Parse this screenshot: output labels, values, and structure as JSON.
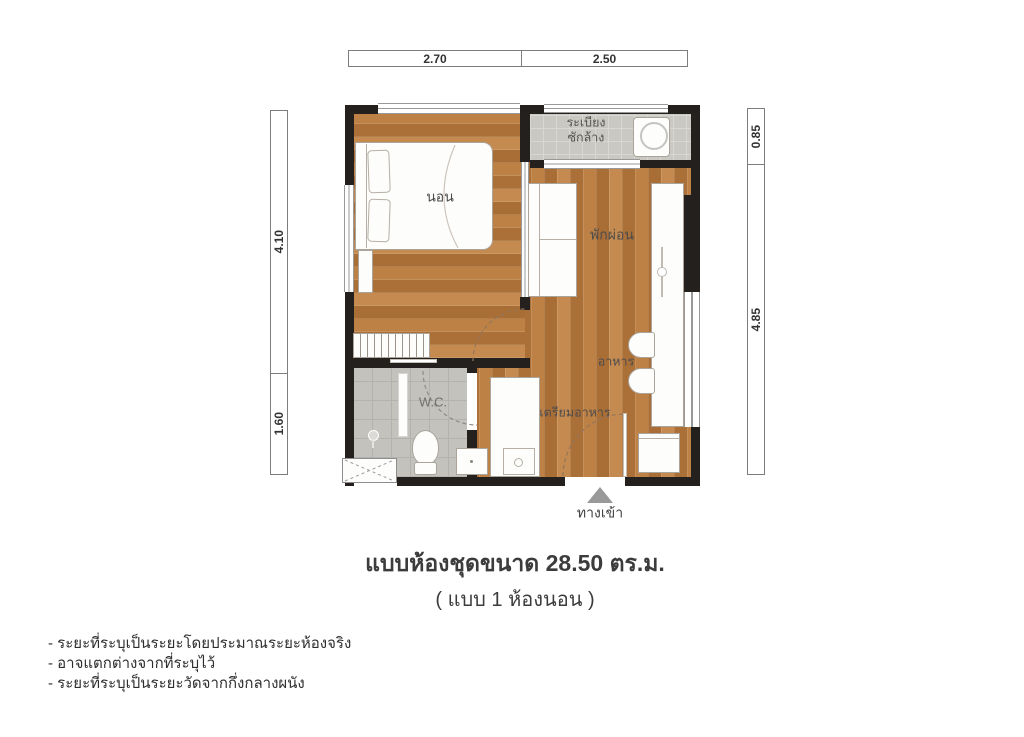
{
  "title": "แบบห้องชุดขนาด 28.50 ตร.ม.",
  "subtitle": "( แบบ 1 ห้องนอน )",
  "notes": [
    "- ระยะที่ระบุเป็นระยะโดยประมาณระยะห้องจริง",
    "- อาจแตกต่างจากที่ระบุไว้",
    "- ระยะที่ระบุเป็นระยะวัดจากกึ่งกลางผนัง"
  ],
  "dimensions": {
    "top": [
      "2.70",
      "2.50"
    ],
    "left": [
      "4.10",
      "1.60"
    ],
    "right": [
      "0.85",
      "4.85"
    ]
  },
  "rooms": {
    "bedroom": "นอน",
    "balcony_line1": "ระเบียง",
    "balcony_line2": "ซักล้าง",
    "living": "พักผ่อน",
    "dining": "อาหาร",
    "kitchen": "เตรียมอาหาร",
    "wc": "W.C.",
    "entrance": "ทางเข้า"
  },
  "area_sqm": "28.50",
  "bedrooms_count": "1",
  "colors": {
    "wall": "#23201d",
    "wood_floor": "#b97c43",
    "balcony_tile": "#c9c8c3",
    "bathroom_tile": "#c4c2bd",
    "furniture": "#fdfdfc",
    "entrance_arrow": "#999999",
    "text": "#3c3c3c"
  }
}
